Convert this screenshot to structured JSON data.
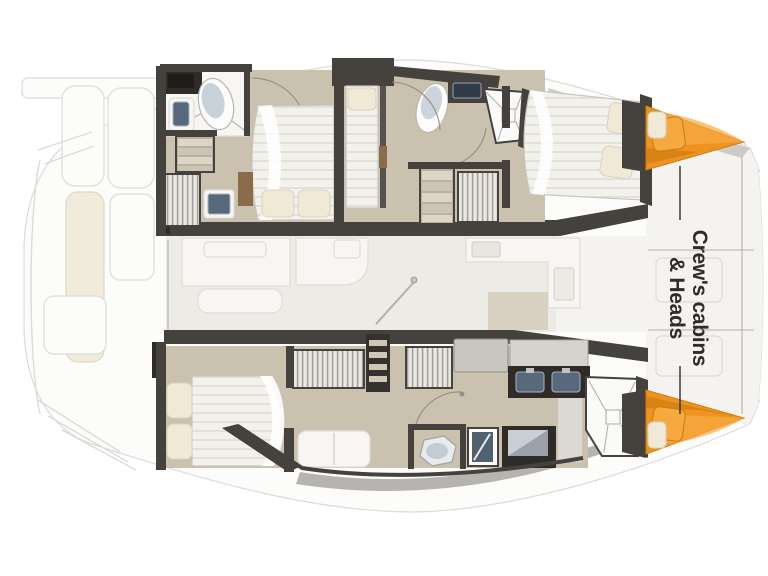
{
  "annotation": {
    "line1": "Crew's cabins",
    "line2": "& Heads"
  },
  "colors": {
    "page": "#ffffff",
    "hullFill": "#fdfdfc",
    "faint": "#dcdbd8",
    "wall": "#45413c",
    "wallDark": "#2f2c28",
    "floor": "#cbc1af",
    "floorLight": "#d9d1c2",
    "saloonFloor": "#edebe5",
    "deckWhite": "#f4f3f0",
    "deckGray": "#c2bfba",
    "fixture": "#f7f6f3",
    "fixtureStroke": "#e0ddd7",
    "bedStroke": "#c9c5bc",
    "pillow": "#f0e9d6",
    "pillowStroke": "#d9d2bd",
    "sink": "#57697b",
    "sinkDark": "#31404e",
    "orange": "#ef9320",
    "orangeDark": "#cf7d10",
    "orangeLight": "#f6ab45",
    "cream": "#f1ebdb",
    "wood": "#8a6b4a",
    "arc": "#948d81",
    "leader": "#3c3b39",
    "text": "#2e2d2b"
  }
}
